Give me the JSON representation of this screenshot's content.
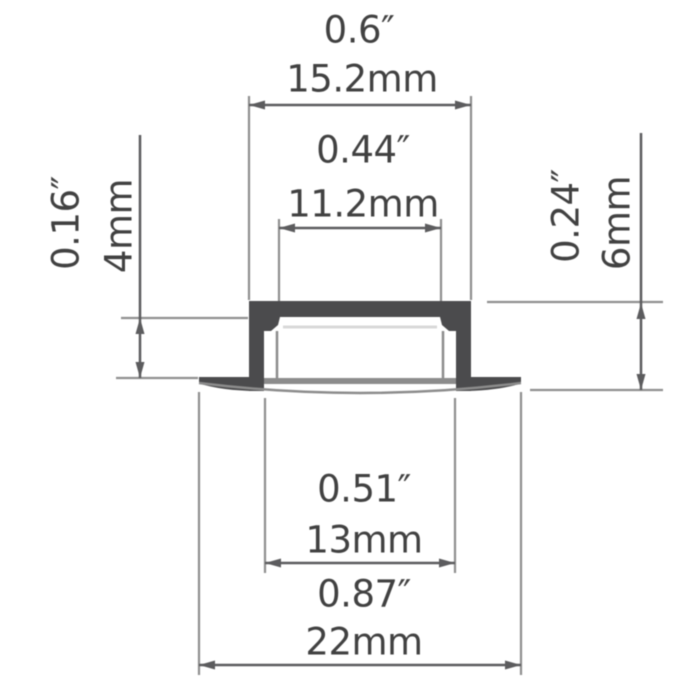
{
  "diagram": {
    "kind": "led-profile-cross-section-dimension-drawing",
    "dimensions": {
      "top_width": {
        "inches": "0.6″",
        "mm": "15.2mm"
      },
      "inner_width": {
        "inches": "0.44″",
        "mm": "11.2mm"
      },
      "recess_depth": {
        "inches": "0.16″",
        "mm": "4mm"
      },
      "total_height": {
        "inches": "0.24″",
        "mm": "6mm"
      },
      "body_width": {
        "inches": "0.51″",
        "mm": "13mm"
      },
      "overall_width": {
        "inches": "0.87″",
        "mm": "22mm"
      }
    },
    "colors": {
      "bg": "#ffffff",
      "profile": "#4b4b4d",
      "dimline": "#5c5c5e",
      "ext": "#8f8f8f",
      "chan": "#8c8c8c",
      "faint": "#d8d8d8",
      "text": "#414141"
    }
  }
}
